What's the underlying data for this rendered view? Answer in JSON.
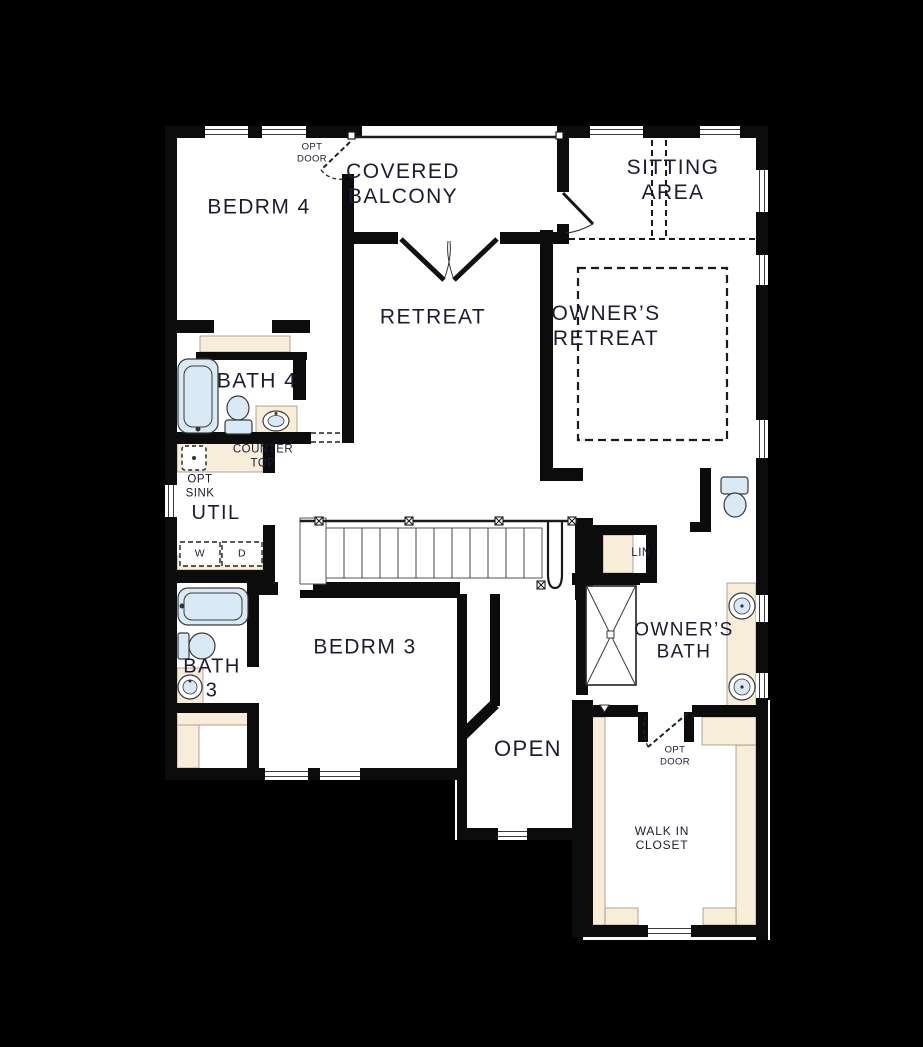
{
  "colors": {
    "background": "#000000",
    "wall": "#0c0c0c",
    "floor": "#ffffff",
    "counter": "#f8edd8",
    "fixture": "#d9e9f6",
    "text": "#1b1b33"
  },
  "rooms": {
    "bedrm4": {
      "label": "BEDRM 4"
    },
    "covered_balcony": {
      "label": "COVERED\nBALCONY"
    },
    "sitting_area": {
      "label": "SITTING\nAREA"
    },
    "retreat": {
      "label": "RETREAT"
    },
    "owners_retreat": {
      "label": "OWNER’S\nRETREAT"
    },
    "bath4": {
      "label": "BATH 4"
    },
    "util": {
      "label": "UTIL"
    },
    "bedrm3": {
      "label": "BEDRM 3"
    },
    "bath3": {
      "label": "BATH\n3"
    },
    "owners_bath": {
      "label": "OWNER’S\nBATH"
    },
    "open_below": {
      "label": "OPEN"
    },
    "walk_in_closet": {
      "label": "WALK IN\nCLOSET"
    },
    "linen": {
      "label": "LIN"
    }
  },
  "annotations": {
    "opt_door_upper": {
      "label": "OPT\nDOOR"
    },
    "opt_door_lower": {
      "label": "OPT\nDOOR"
    },
    "counter_top": {
      "label": "COUNTER\nTOP"
    },
    "opt_sink": {
      "label": "OPT\nSINK"
    },
    "washer": {
      "label": "W"
    },
    "dryer": {
      "label": "D"
    }
  }
}
